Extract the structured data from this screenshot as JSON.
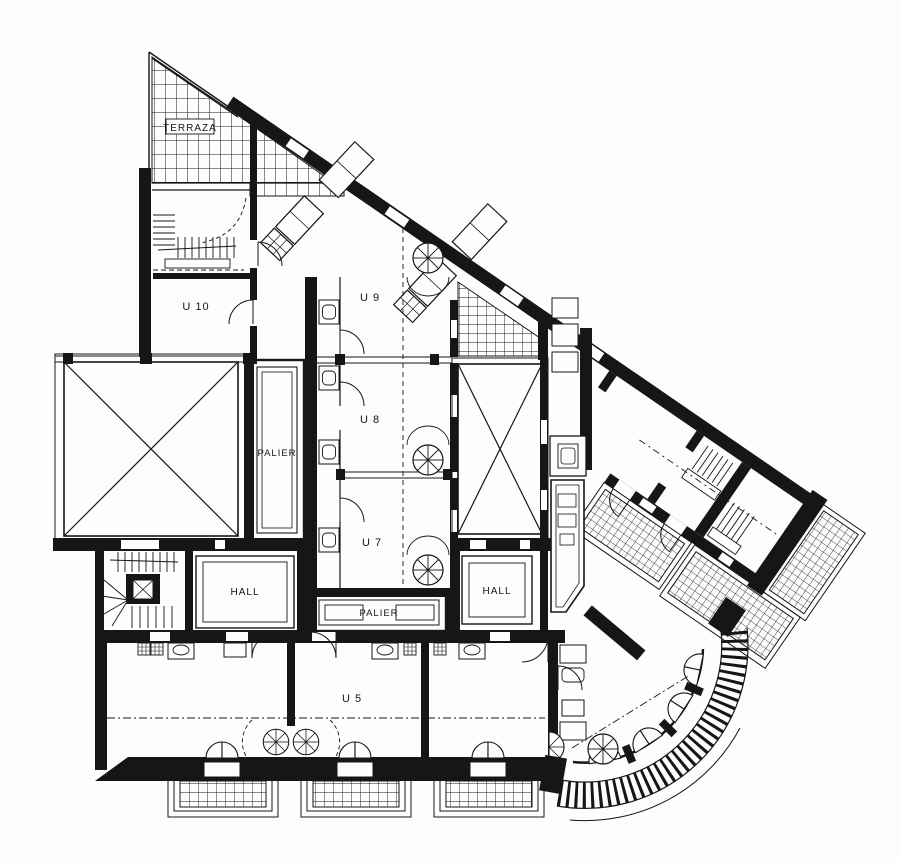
{
  "figure": {
    "type": "architectural-floor-plan",
    "style": "black and white line drawing, hatched terraces and balconies"
  },
  "palette": {
    "ink": "#161616",
    "paper": "#fdfdfb"
  },
  "labels": {
    "terraza": "TERRAZA",
    "u10": "U 10",
    "u9": "U 9",
    "u8": "U 8",
    "u7": "U 7",
    "u5": "U 5",
    "palier_left": "PALIER",
    "palier_bottom": "PALIER",
    "hall_left": "HALL",
    "hall_right": "HALL"
  }
}
